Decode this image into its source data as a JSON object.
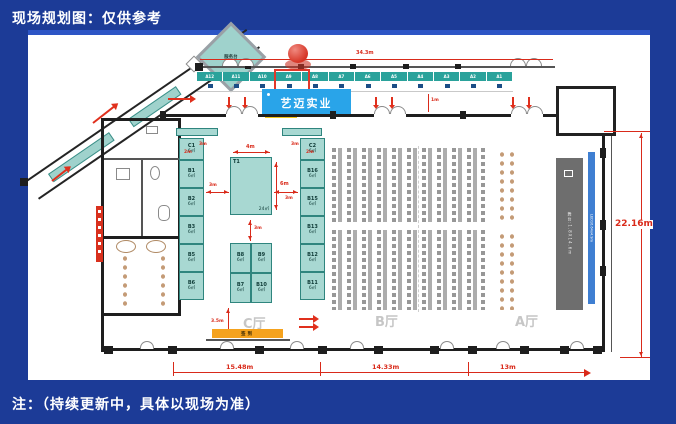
{
  "header": {
    "title": "现场规划图：仅供参考"
  },
  "footer": {
    "note": "注：（持续更新中，具体以现场为准）"
  },
  "plan": {
    "callout": "艺迈实业",
    "hall_c": "C厅",
    "hall_b": "B厅",
    "hall_a": "A厅",
    "top_booths": [
      "A12",
      "A11",
      "A10",
      "A9",
      "A8",
      "A7",
      "A6",
      "A5",
      "A4",
      "A3",
      "A2",
      "A1"
    ],
    "highlighted_booth": "A9",
    "left_column": [
      {
        "id": "C1",
        "size": "6㎡"
      },
      {
        "id": "B1",
        "size": "6㎡"
      },
      {
        "id": "B2",
        "size": "6㎡"
      },
      {
        "id": "B3",
        "size": "6㎡"
      },
      {
        "id": "B5",
        "size": "6㎡"
      },
      {
        "id": "B6",
        "size": "6㎡"
      }
    ],
    "right_column": [
      {
        "id": "C2",
        "size": "6㎡"
      },
      {
        "id": "B16",
        "size": "6㎡"
      },
      {
        "id": "B15",
        "size": "6㎡"
      },
      {
        "id": "B13",
        "size": "6㎡"
      },
      {
        "id": "B12",
        "size": "6㎡"
      },
      {
        "id": "B11",
        "size": "6㎡"
      }
    ],
    "center_booth": {
      "id": "T1",
      "area": "24㎡"
    },
    "quad": [
      {
        "id": "B8",
        "size": "6㎡"
      },
      {
        "id": "B9",
        "size": "6㎡"
      },
      {
        "id": "B7",
        "size": "6㎡"
      },
      {
        "id": "B10",
        "size": "6㎡"
      }
    ],
    "stage_label": "舞台:1.8X14.6m",
    "led_label": "LED16.64x4.9m",
    "service_desk": "服务台",
    "signin": "签到",
    "dims": {
      "top": "34.3m",
      "right": "22.16m",
      "bottom_left": "15.48m",
      "bottom_mid": "14.33m",
      "bottom_right": "13m",
      "t1_width": "4m",
      "t1_height": "6m",
      "gap_3m": "3m",
      "c_width": "2m",
      "front": "3.5m",
      "foyer": "1m"
    }
  },
  "colors": {
    "background": "#1c3b97",
    "accent_red": "#d92a1a",
    "booth_teal": "#a8d8d2",
    "booth_bar_teal": "#2aa29b",
    "furniture_navy": "#1c4d86",
    "callout_blue": "#29a4e9",
    "stage_gray": "#6e6e6e",
    "led_blue": "#3f7fd2",
    "signin_orange": "#f5a21d"
  }
}
